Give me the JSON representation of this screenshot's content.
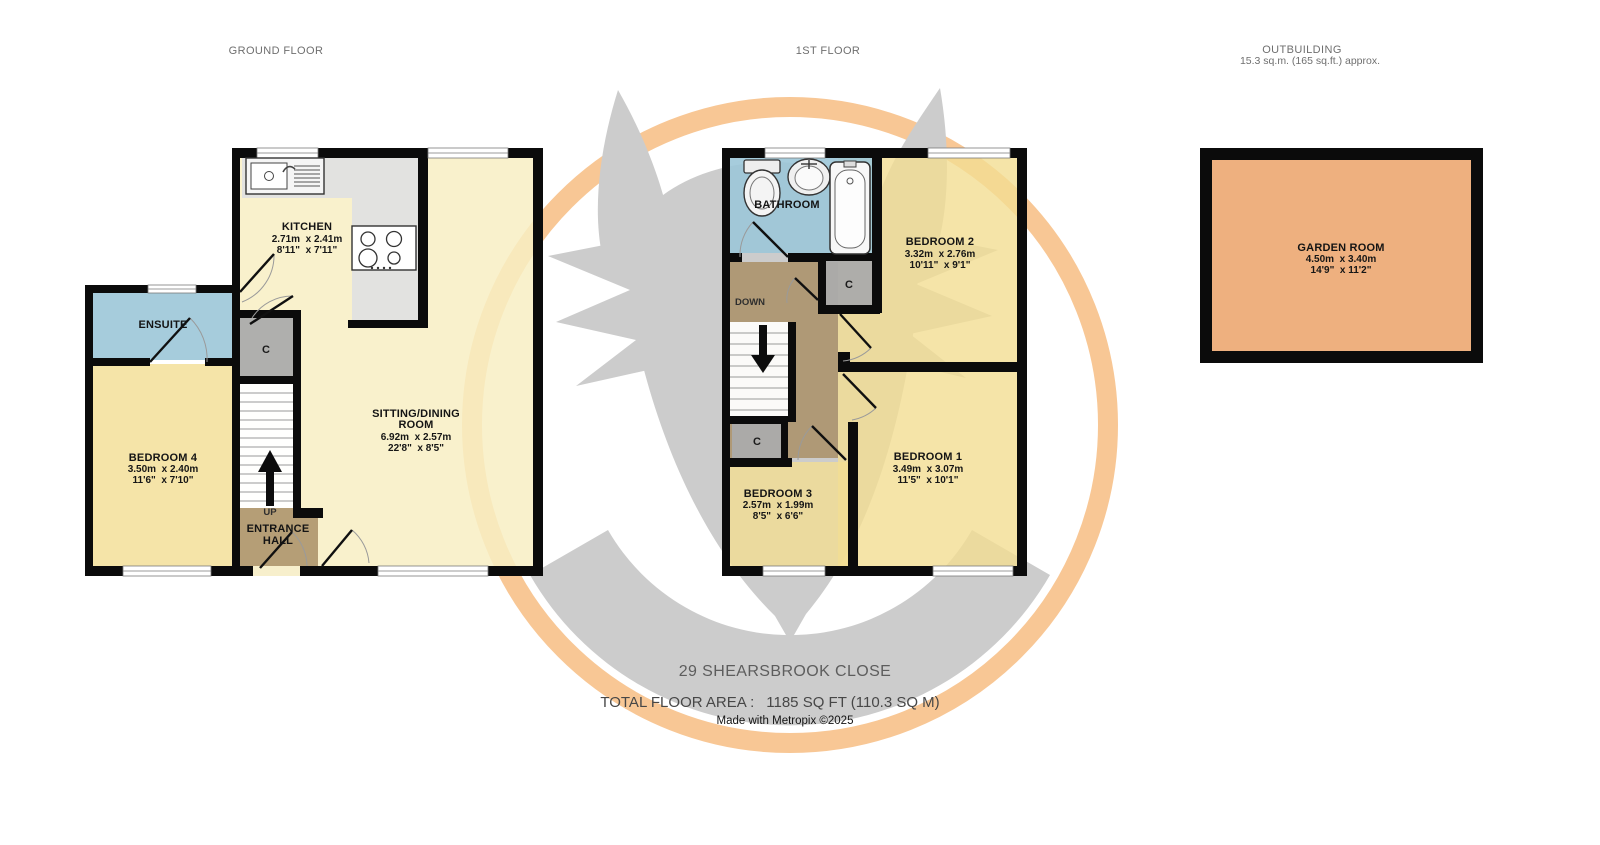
{
  "labels": {
    "ground_floor": "GROUND FLOOR",
    "first_floor": "1ST FLOOR",
    "outbuilding_title": "OUTBUILDING",
    "outbuilding_area": "15.3 sq.m. (165 sq.ft.) approx.",
    "up": "UP",
    "down": "DOWN",
    "cupboard": "C"
  },
  "rooms": {
    "kitchen": {
      "name": "KITCHEN",
      "metric": "2.71m  x 2.41m",
      "imperial": "8'11\"  x 7'11\""
    },
    "sitting": {
      "name_line1": "SITTING/DINING",
      "name_line2": "ROOM",
      "metric": "6.92m  x 2.57m",
      "imperial": "22'8\"  x 8'5\""
    },
    "ensuite": {
      "name": "ENSUITE"
    },
    "bedroom4": {
      "name": "BEDROOM 4",
      "metric": "3.50m  x 2.40m",
      "imperial": "11'6\"  x 7'10\""
    },
    "entrance": {
      "line1": "ENTRANCE",
      "line2": "HALL"
    },
    "bathroom": {
      "name": "BATHROOM"
    },
    "bedroom2": {
      "name": "BEDROOM 2",
      "metric": "3.32m  x 2.76m",
      "imperial": "10'11\"  x 9'1\""
    },
    "bedroom1": {
      "name": "BEDROOM 1",
      "metric": "3.49m  x 3.07m",
      "imperial": "11'5\"  x 10'1\""
    },
    "bedroom3": {
      "name": "BEDROOM 3",
      "metric": "2.57m  x 1.99m",
      "imperial": "8'5\"  x 6'6\""
    },
    "garden": {
      "name": "GARDEN ROOM",
      "metric": "4.50m  x 3.40m",
      "imperial": "14'9\"  x 11'2\""
    }
  },
  "footer": {
    "address": "29 SHEARSBROOK CLOSE",
    "total_label": "TOTAL FLOOR AREA :",
    "total_value": "1185 SQ FT (110.3 SQ M)",
    "credit": "Made with Metropix ©2025"
  },
  "colors": {
    "wall": "#0b0b0b",
    "bedroom_fill": "#f2dd92",
    "living_fill": "#f8efc3",
    "wet_room_fill": "#9cc7d8",
    "hall_fill": "#a98f66",
    "cupboard_fill": "#ababab",
    "counter_fill": "#e0e0e0",
    "garden_fill": "#eeb07f",
    "watermark_gray": "#cccccc",
    "watermark_orange": "#f8c795"
  }
}
